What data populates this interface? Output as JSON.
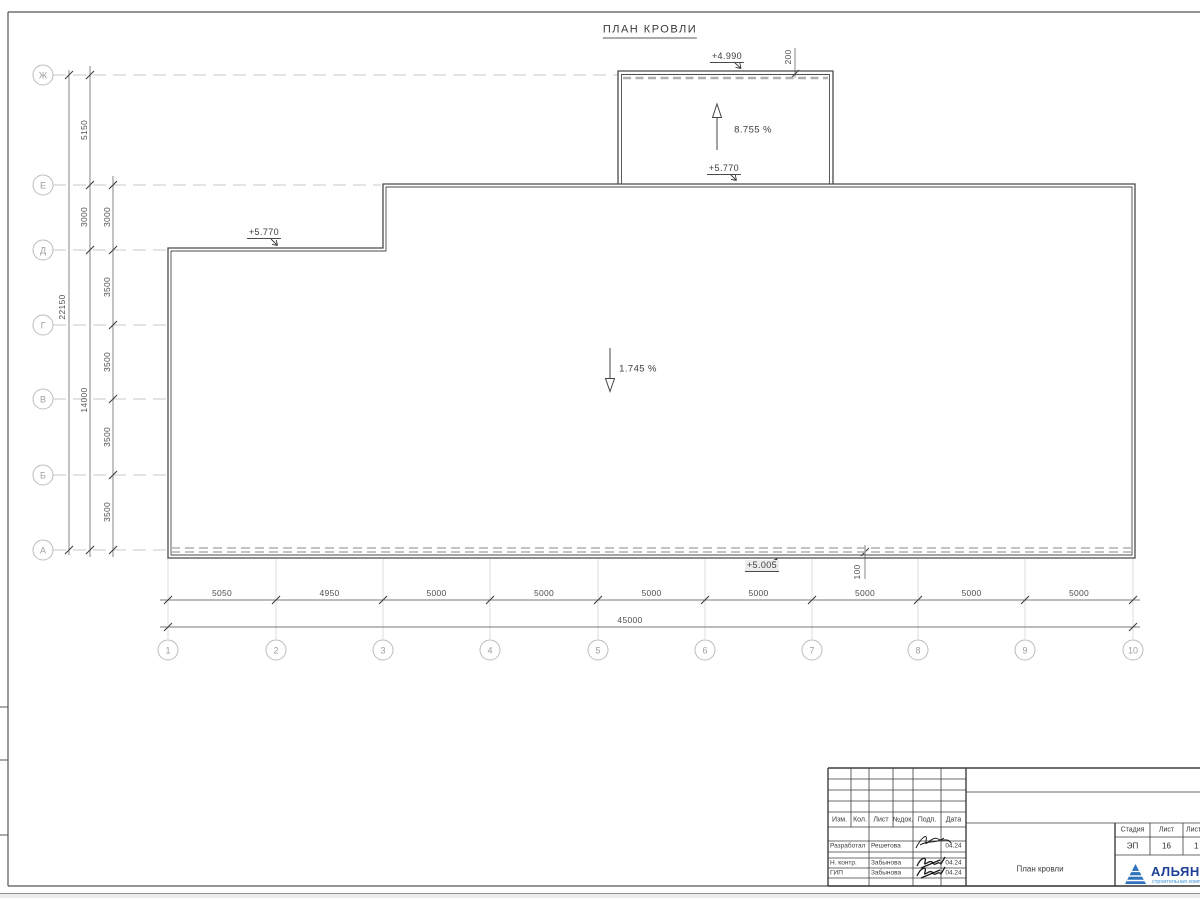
{
  "sheet": {
    "title": "ПЛАН КРОВЛИ"
  },
  "axes": {
    "rows": [
      "Ж",
      "Е",
      "Д",
      "Г",
      "В",
      "Б",
      "А"
    ],
    "cols": [
      "1",
      "2",
      "3",
      "4",
      "5",
      "6",
      "7",
      "8",
      "9",
      "10"
    ]
  },
  "dimensions": {
    "left_total": "22150",
    "left_mid": [
      "5150",
      "3000",
      "14000"
    ],
    "left_inner": [
      "3000",
      "3500",
      "3500",
      "3500",
      "3500"
    ],
    "bottom": [
      "5050",
      "4950",
      "5000",
      "5000",
      "5000",
      "5000",
      "5000",
      "5000",
      "5000"
    ],
    "bottom_total": "45000",
    "parapet_top": "200",
    "parapet_bottom": "100"
  },
  "annotations": {
    "elev_top": "+4.990",
    "slope_upper": "8.755 %",
    "elev_upper_base": "+5.770",
    "elev_left": "+5.770",
    "slope_main": "1.745 %",
    "elev_bottom": "+5.005"
  },
  "title_block": {
    "header": [
      "Изм.",
      "Кол.",
      "Лист",
      "№док.",
      "Подп.",
      "Дата"
    ],
    "rows": [
      {
        "role": "Разработал",
        "name": "Решетова",
        "date": "04.24"
      },
      {
        "role": "Н. контр.",
        "name": "Забынова",
        "date": "04.24"
      },
      {
        "role": "ГИП",
        "name": "Забынова",
        "date": "04.24"
      }
    ],
    "drawing_title": "План кровли",
    "stage_label": "Стадия",
    "stage_value": "ЭП",
    "sheet_label": "Лист",
    "sheet_value": "16",
    "sheets_label": "Листов",
    "sheets_value": "1",
    "logo_text": "АЛЬЯНС",
    "logo_subtitle": "строительная компания"
  },
  "colors": {
    "logo_triangle": "#2f74ba",
    "logo_text": "#1d4096",
    "logo_subtitle": "#3f93d8",
    "line_dark": "#4a4a4a",
    "line_light": "#c9c9c9"
  }
}
